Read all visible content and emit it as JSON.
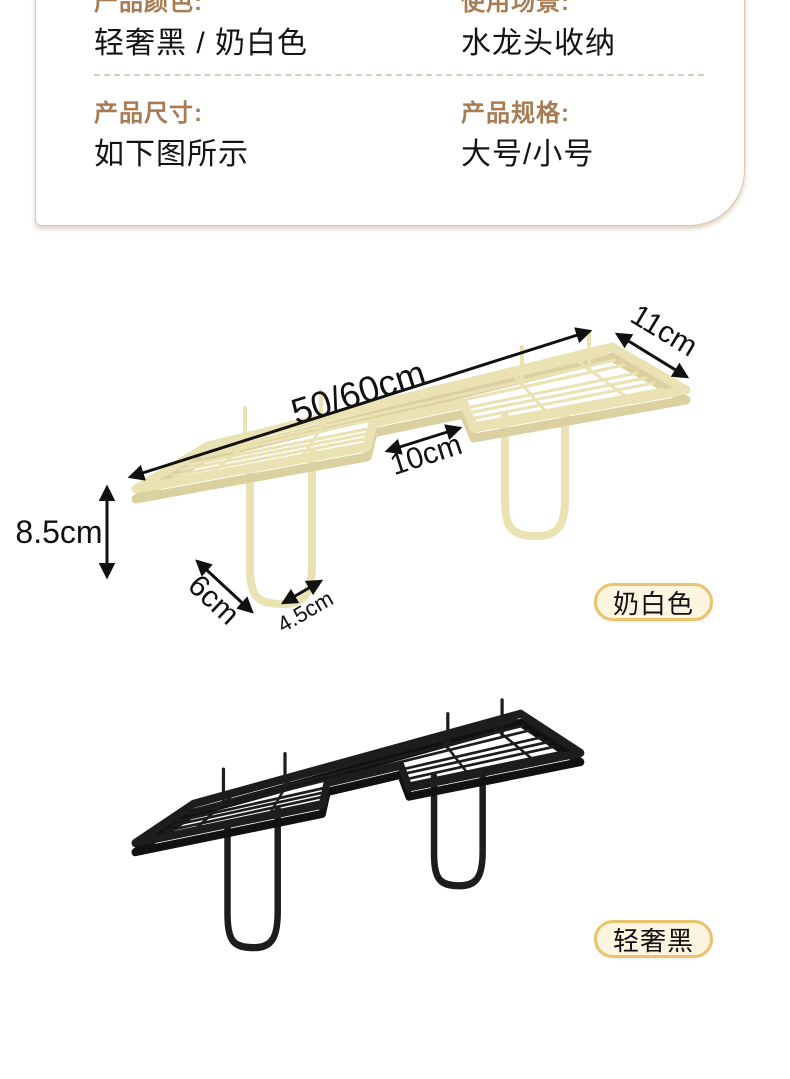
{
  "info_card": {
    "rows": [
      {
        "label": "产品颜色:",
        "value": "轻奢黑 / 奶白色"
      },
      {
        "label": "使用场景:",
        "value": "水龙头收纳"
      },
      {
        "label": "产品尺寸:",
        "value": "如下图所示"
      },
      {
        "label": "产品规格:",
        "value": "大号/小号"
      }
    ],
    "label_color": "#a87b52",
    "border_color": "#dcc8b2"
  },
  "diagram": {
    "dimensions": {
      "length": "50/60cm",
      "depth": "11cm",
      "notch_width": "10cm",
      "height": "8.5cm",
      "hook_depth": "6cm",
      "hook_width": "4.5cm"
    },
    "badges": [
      {
        "text": "奶白色"
      },
      {
        "text": "轻奢黑"
      }
    ],
    "colors": {
      "cream_rack": "#ebe2b4",
      "black_rack": "#1d1d1d",
      "badge_bg": "#fdf5e0",
      "badge_border": "#e9c46d",
      "annotation": "#111111"
    }
  }
}
